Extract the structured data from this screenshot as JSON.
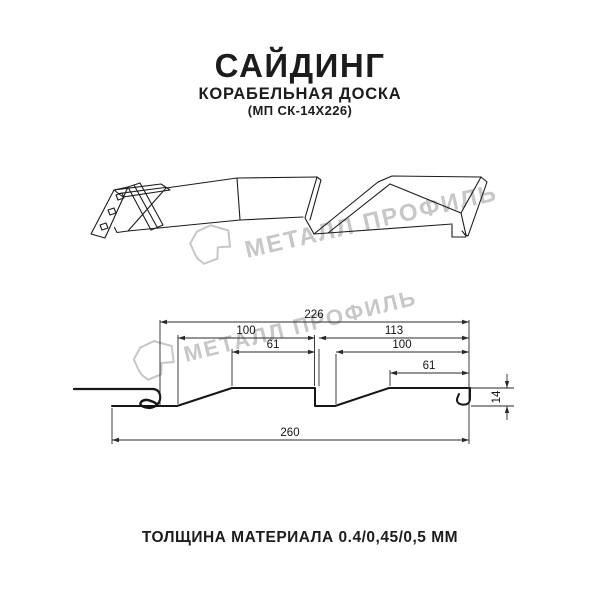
{
  "header": {
    "title": "САЙДИНГ",
    "subtitle": "КОРАБЕЛЬНАЯ ДОСКА",
    "model": "(МП СК-14Х226)"
  },
  "watermark": {
    "brand": "МЕТАЛЛ ПРОФИЛЬ"
  },
  "section": {
    "dims": {
      "total_cover": "226",
      "left_wave": "100",
      "right_wave": "113",
      "left_flat": "61",
      "right_inner": "100",
      "right_flat": "61",
      "overall": "260",
      "depth": "14"
    }
  },
  "footer": {
    "thickness_label": "ТОЛЩИНА МАТЕРИАЛА 0.4/0,45/0,5 ММ"
  },
  "colors": {
    "ink": "#1c1c1c",
    "line": "#2a2a2a",
    "watermark": "#c7c7c7",
    "background": "#ffffff"
  }
}
